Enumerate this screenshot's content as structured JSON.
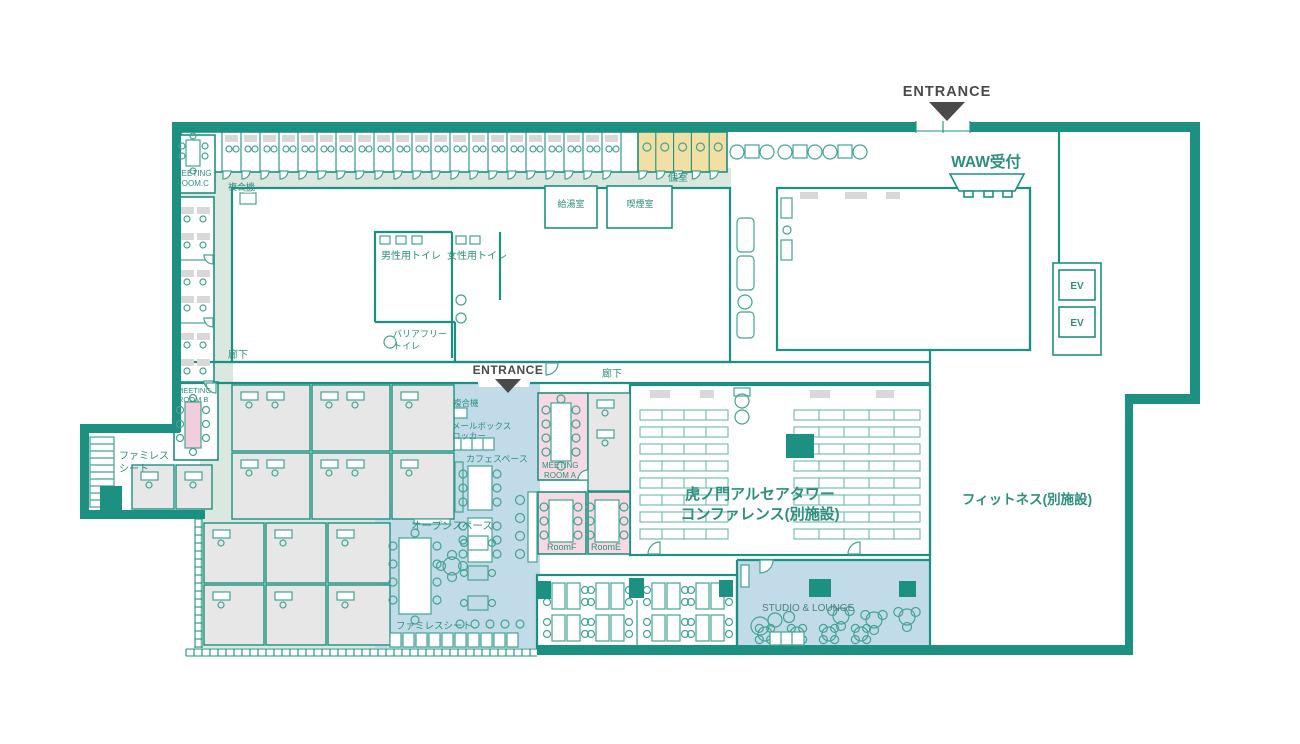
{
  "colors": {
    "wall_teal": "#1d9181",
    "corridor_sage": "#dae8e0",
    "open_area_blue": "#c2dbe9",
    "meeting_pink": "#f7d9e3",
    "booth_yellow": "#f1dfa3",
    "office_gray": "#e7e7e7",
    "label_teal": "#2e8f7e",
    "label_dark": "#4a4a4a"
  },
  "labels": {
    "entrance_top": "ENTRANCE",
    "entrance_mid": "ENTRANCE",
    "waw_reception": "WAW受付",
    "meeting_room_c_1": "MEETING",
    "meeting_room_c_2": "ROOM.C",
    "meeting_room_b_1": "MEETING",
    "meeting_room_b_2": "ROOM B",
    "meeting_room_a_1": "MEETING",
    "meeting_room_a_2": "ROOM A",
    "copier_top": "複合機",
    "copier_mid": "複合機",
    "private_rooms": "個室",
    "kitchenette": "給湯室",
    "smoking_room": "喫煙室",
    "mens_toilet": "男性用トイレ",
    "womens_toilet": "女性用トイレ",
    "barrier_free_1": "バリアフリー",
    "barrier_free_2": "トイレ",
    "corridor_left": "廊下",
    "corridor_mid": "廊下",
    "mailbox_1": "メールボックス",
    "mailbox_2": "ロッカー",
    "cafe_space": "カフェスペース",
    "family_seat_1": "ファミレス",
    "family_seat_2": "シート",
    "family_seat_bottom": "ファミレスシート",
    "open_space": "オープンスペース",
    "room_f": "RoomF",
    "room_e": "RoomE",
    "conference_1": "虎ノ門アルセアタワー",
    "conference_2": "コンファレンス(別施設)",
    "fitness": "フィットネス(別施設)",
    "studio_lounge": "STUDIO & LOUNGE",
    "ev_1": "EV",
    "ev_2": "EV"
  }
}
